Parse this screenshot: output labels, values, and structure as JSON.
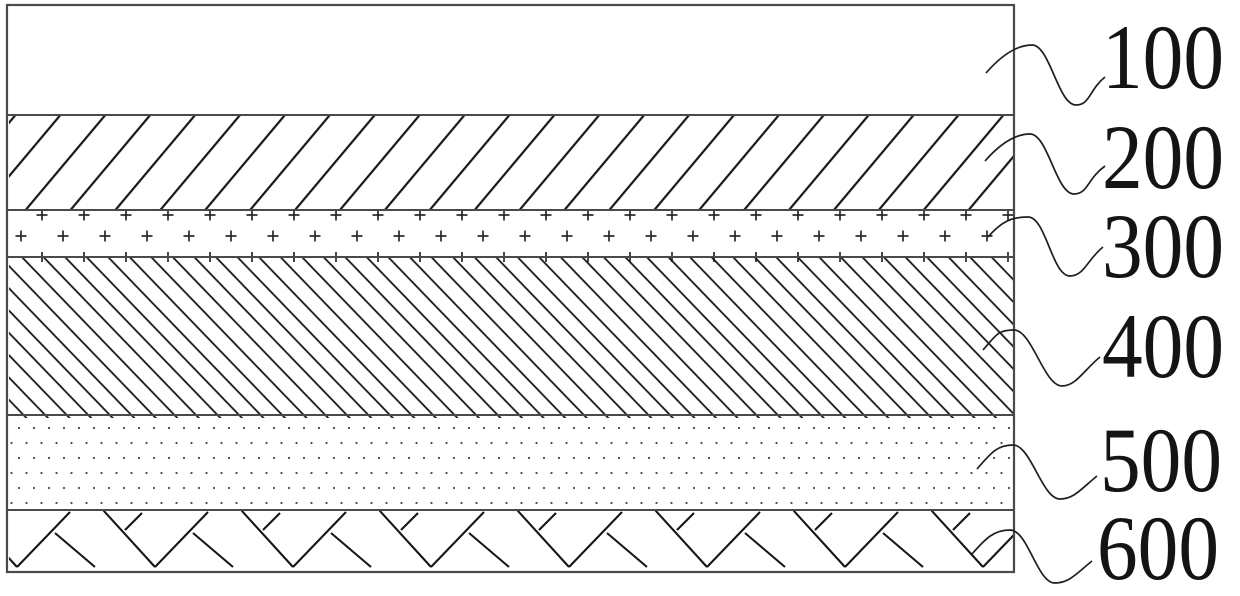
{
  "figure": {
    "kind": "layered-structure-cross-section",
    "background_color": "#ffffff",
    "hatch_color": "#161616",
    "border_color": "#4a4a4a",
    "label_color": "#141414",
    "layers": [
      {
        "label": "100",
        "pattern": "plain-white"
      },
      {
        "label": "200",
        "pattern": "forward-diagonal-hatch"
      },
      {
        "label": "300",
        "pattern": "plus-sign-hatch"
      },
      {
        "label": "400",
        "pattern": "backward-diagonal-hatch"
      },
      {
        "label": "500",
        "pattern": "dot-stipple"
      },
      {
        "label": "600",
        "pattern": "herringbone-weave"
      }
    ]
  }
}
